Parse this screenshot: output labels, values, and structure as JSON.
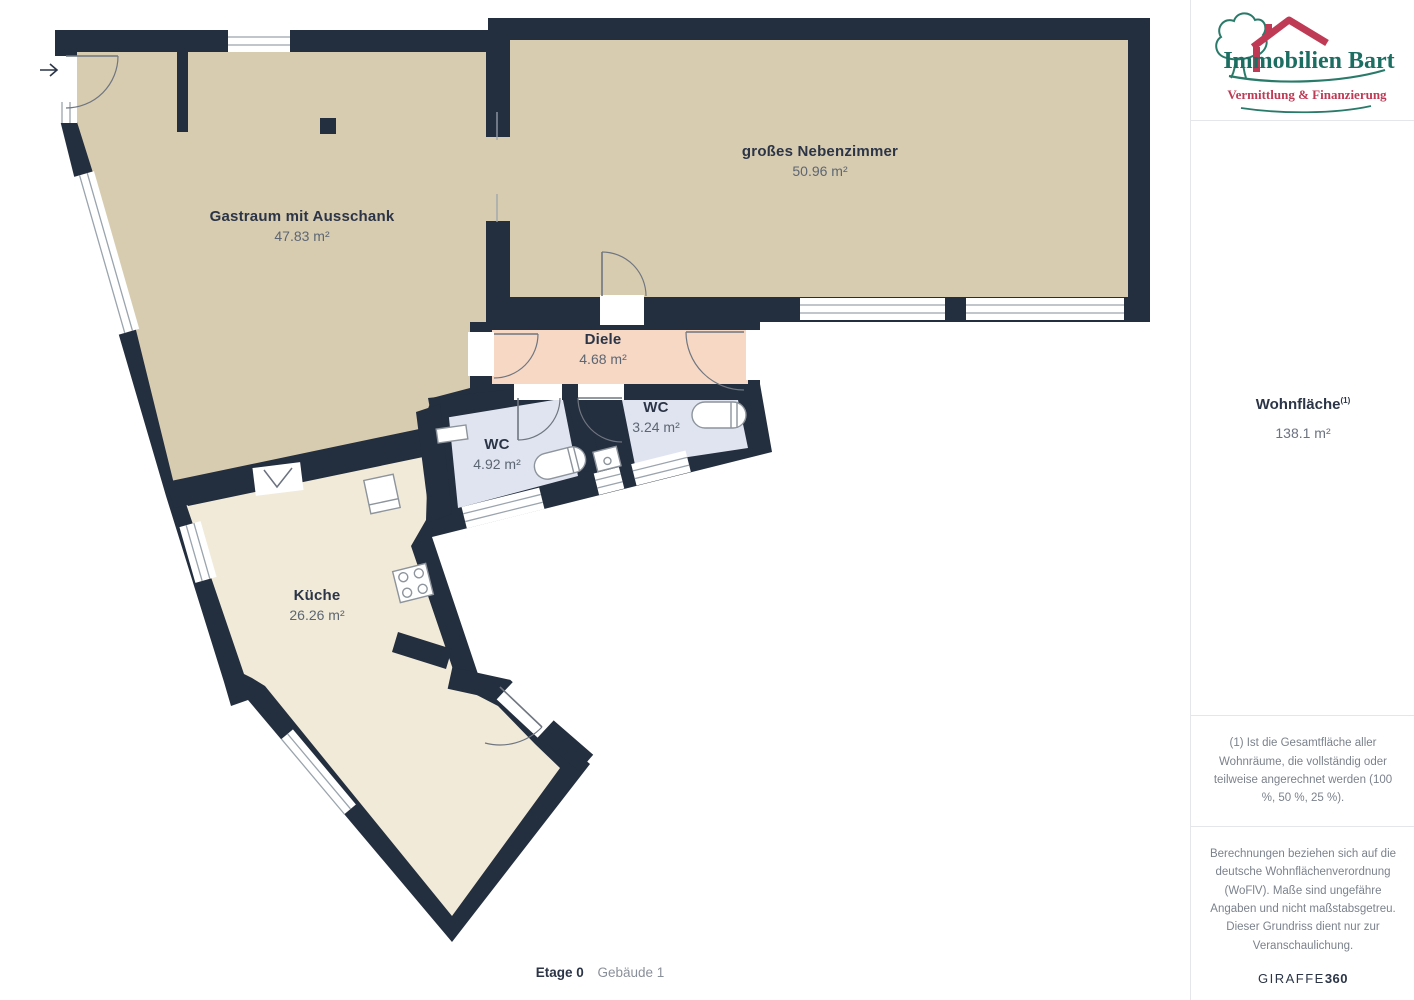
{
  "plan": {
    "wall_color": "#232e3e",
    "rooms": [
      {
        "id": "gastraum",
        "name": "Gastraum mit Ausschank",
        "area": "47.83 m²",
        "color": "#d8ccb0"
      },
      {
        "id": "nebenzimmer",
        "name": "großes Nebenzimmer",
        "area": "50.96 m²",
        "color": "#d8ccb0"
      },
      {
        "id": "diele",
        "name": "Diele",
        "area": "4.68 m²",
        "color": "#f6d8c5"
      },
      {
        "id": "wc-klein",
        "name": "WC",
        "area": "3.24 m²",
        "color": "#e0e4f0"
      },
      {
        "id": "wc-gross",
        "name": "WC",
        "area": "4.92 m²",
        "color": "#e0e4f0"
      },
      {
        "id": "kueche",
        "name": "Küche",
        "area": "26.26 m²",
        "color": "#f1ead8"
      }
    ],
    "icons": [
      "entrance-arrow-icon",
      "toilet-icon",
      "sink-icon",
      "stove-icon",
      "cupboard-icon",
      "column-marker"
    ],
    "floor_label": "Etage 0",
    "building_label": "Gebäude 1"
  },
  "sidebar": {
    "logo": {
      "title": "Immobilien Bart",
      "subtitle": "Vermittlung & Finanzierung",
      "title_color": "#1d6e62",
      "accent_color": "#bf3a55"
    },
    "area_summary": {
      "label": "Wohnfläche",
      "superscript": "(1)",
      "value": "138.1 m²"
    },
    "footnote": "(1) Ist die Gesamtfläche aller Wohnräume, die vollständig oder teilweise angerechnet werden (100 %, 50 %, 25 %).",
    "disclaimer": "Berechnungen beziehen sich auf die deutsche Wohnflächenverordnung (WoFlV). Maße sind ungefähre Angaben und nicht maßstabsgetreu. Dieser Grundriss dient nur zur Veranschaulichung.",
    "brand": {
      "name": "GIRAFFE",
      "suffix": "360"
    }
  }
}
